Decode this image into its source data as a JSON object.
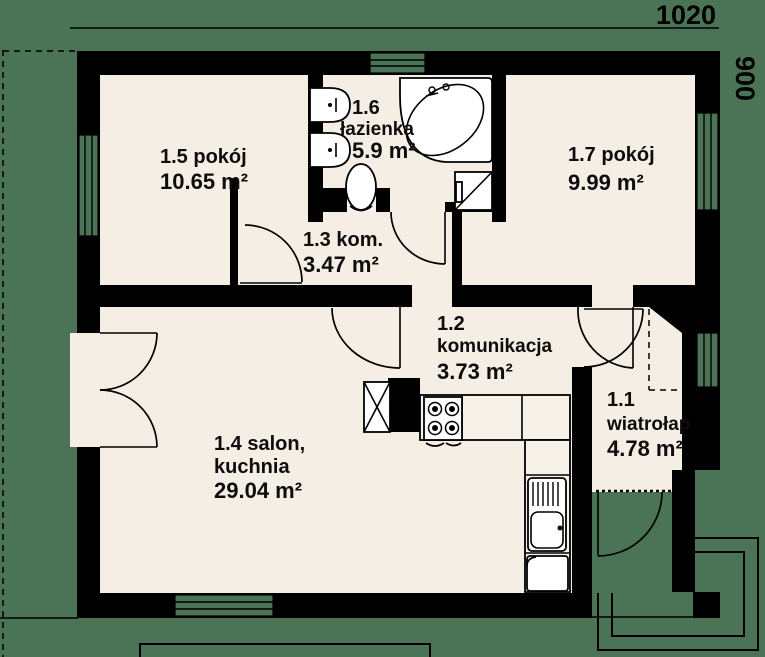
{
  "plan_title": "floor plan",
  "dimensions": {
    "width_label": "1020",
    "height_label": "900"
  },
  "rooms": [
    {
      "id": "1.5",
      "name": "pokój",
      "area": "10.65 m²",
      "lines": [
        "1.5 pokój",
        "10.65 m²"
      ]
    },
    {
      "id": "1.6",
      "name": "łazienka",
      "area": "5.9 m²",
      "lines": [
        "1.6",
        "łazienka",
        "5.9 m²"
      ]
    },
    {
      "id": "1.7",
      "name": "pokój",
      "area": "9.99 m²",
      "lines": [
        "1.7 pokój",
        "9.99 m²"
      ]
    },
    {
      "id": "1.3",
      "name": "kom.",
      "area": "3.47 m²",
      "lines": [
        "1.3 kom.",
        "3.47 m²"
      ]
    },
    {
      "id": "1.2",
      "name": "komunikacja",
      "area": "3.73 m²",
      "lines": [
        "1.2",
        "komunikacja",
        "3.73 m²"
      ]
    },
    {
      "id": "1.4",
      "name": "salon, kuchnia",
      "area": "29.04 m²",
      "lines": [
        "1.4 salon,",
        "kuchnia",
        "29.04 m²"
      ]
    },
    {
      "id": "1.1",
      "name": "wiatrołap",
      "area": "4.78 m²",
      "lines": [
        "1.1",
        "wiatrołap",
        "4.78 m²"
      ]
    }
  ],
  "colors": {
    "wall": "#000000",
    "floor": "#f4eee4",
    "ground": "#4b7355",
    "text": "#0d0d0d"
  }
}
